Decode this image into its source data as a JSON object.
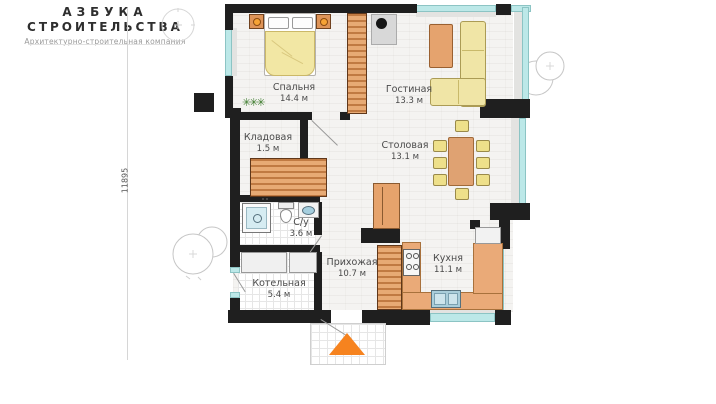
{
  "brand": {
    "line1": "АЗБУКА",
    "line2": "СТРОИТЕЛЬСТВА",
    "tagline": "Архитектурно-строительная компания"
  },
  "dimension": {
    "left_total": "11895"
  },
  "rooms": [
    {
      "id": "bedroom",
      "name": "Спальня",
      "area": "14.4 м"
    },
    {
      "id": "living",
      "name": "Гостиная",
      "area": "13.3 м"
    },
    {
      "id": "storage",
      "name": "Кладовая",
      "area": "1.5 м"
    },
    {
      "id": "dining",
      "name": "Столовая",
      "area": "13.1 м"
    },
    {
      "id": "bathroom",
      "name": "С/у",
      "area": "3.6 м"
    },
    {
      "id": "hallway",
      "name": "Прихожая",
      "area": "10.7 м"
    },
    {
      "id": "kitchen",
      "name": "Кухня",
      "area": "11.1 м"
    },
    {
      "id": "boiler",
      "name": "Котельная",
      "area": "5.4 м"
    }
  ],
  "icons": {
    "plant_glyph": "✳✳✳",
    "entrance_arrow": "entrance-arrow-icon",
    "compass": "compass-icon",
    "bush": "bush-icon"
  },
  "colors": {
    "wall": "#1f1f1f",
    "window": "#bce8e8",
    "wood_furniture": "#e7aa74",
    "sofa_yellow": "#f0e5a6",
    "accent_orange": "#f6831f",
    "floor": "#f4f3f1"
  }
}
